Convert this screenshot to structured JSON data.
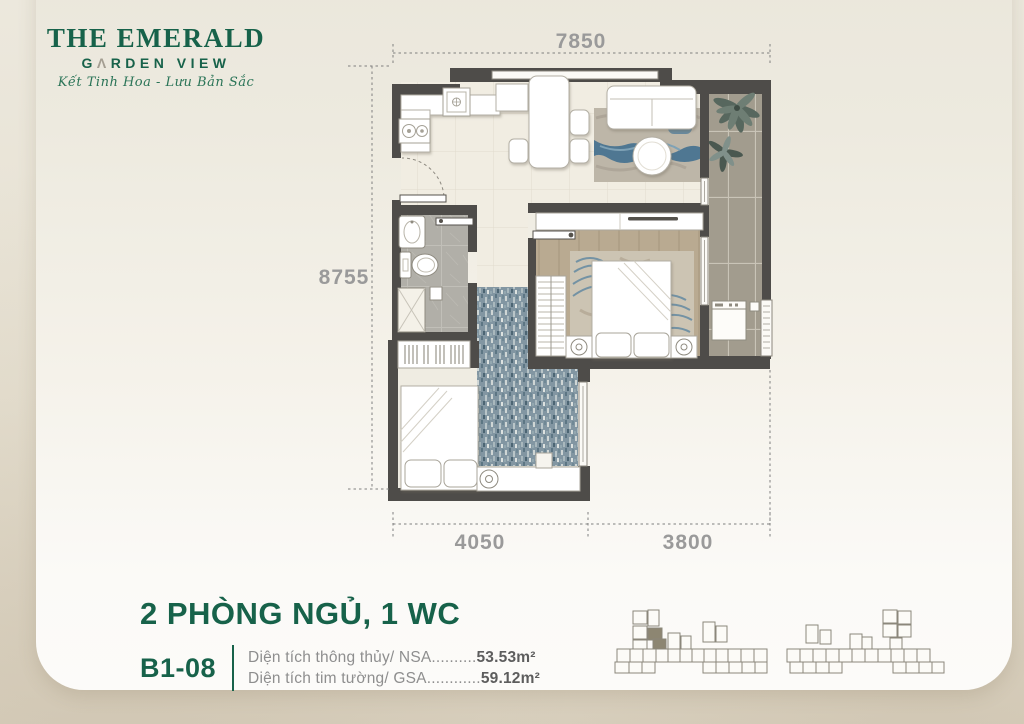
{
  "logo": {
    "line1": "THE EMERALD",
    "line2_pre": "G",
    "line2_mark": "Λ",
    "line2_post": "RDEN VIEW",
    "tagline": "Kết Tinh Hoa - Lưu Bản Sắc"
  },
  "dimensions": {
    "top": "7850",
    "left": "8755",
    "bottom_left": "4050",
    "bottom_right": "3800"
  },
  "unit": {
    "title": "2 PHÒNG NGỦ, 1 WC",
    "code": "B1-08",
    "areas": [
      {
        "label": "Diện tích thông thủy/ NSA",
        "dots": "..........",
        "value": "53.53m²"
      },
      {
        "label": "Diện tích tim tường/ GSA",
        "dots": "............",
        "value": "59.12m²"
      }
    ]
  },
  "colors": {
    "brand_green": "#17624a",
    "dimension_gray": "#9a9a9a",
    "wall": "#4e4c49",
    "keyplan_highlight": "#8d8672"
  }
}
